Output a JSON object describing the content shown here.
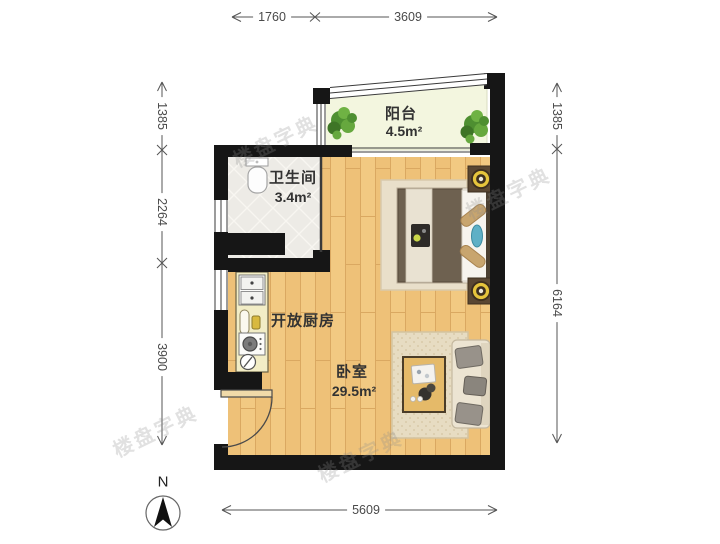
{
  "plan": {
    "rooms": {
      "balcony": {
        "label": "阳台",
        "area": "4.5m²"
      },
      "bathroom": {
        "label": "卫生间",
        "area": "3.4m²"
      },
      "kitchen": {
        "label": "开放厨房"
      },
      "bedroom": {
        "label": "卧室",
        "area": "29.5m²"
      }
    },
    "dimensions": {
      "top": [
        "1760",
        "3609"
      ],
      "left": [
        "1385",
        "2264",
        "3900"
      ],
      "right": [
        "1385",
        "6164"
      ],
      "bottom": [
        "5609"
      ]
    },
    "north_label": "N",
    "watermark": "楼盘字典",
    "colors": {
      "wall": "#161616",
      "wood_floor": "#f2c982",
      "tile_floor": "#edebe6",
      "balcony_floor": "#f3f6df",
      "counter": "#f2edc6",
      "duvet": "#6e6150",
      "runner": "#e9e2d2",
      "pillow_tan": "#c8a56e",
      "pillow_blue": "#5fb0c6",
      "lamp_gold": "#e6c43c",
      "plant_green": "#5a9e3a",
      "sofa_cushion": "#98928a",
      "dimension_line": "#555555"
    }
  }
}
